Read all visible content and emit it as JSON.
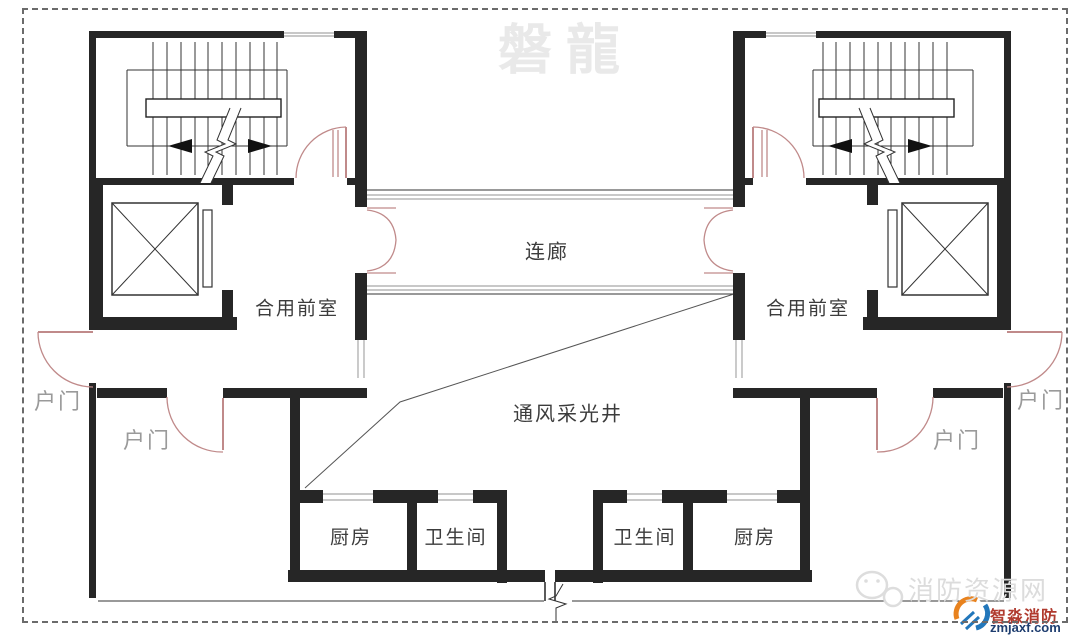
{
  "watermarks": {
    "top_brand": "磐龍",
    "site_name": "消防资源网",
    "logo_title": "智淼消防",
    "logo_domain": "zmjaxf.com"
  },
  "rooms": {
    "corridor": "连廊",
    "light_well": "通风采光井",
    "front_room_left": "合用前室",
    "front_room_right": "合用前室",
    "kitchen_left": "厨房",
    "kitchen_right": "厨房",
    "bathroom_left": "卫生间",
    "bathroom_right": "卫生间"
  },
  "doors": {
    "outer_left": "户门",
    "inner_left": "户门",
    "inner_right": "户门",
    "outer_right": "户门"
  },
  "colors": {
    "wall": "#262626",
    "line_thin": "#555555",
    "window": "#a8a8a8",
    "door_arc": "#c08a8a",
    "room_label": "#3c3c3c",
    "door_label": "#9a9a9a",
    "watermark": "#e9e9e9",
    "site_watermark": "#dcdcdc",
    "logo_red": "#b03a2e",
    "logo_blue": "#1f3e70",
    "logo_orange": "#e8821e",
    "border_dash": "#6b6b6b"
  }
}
